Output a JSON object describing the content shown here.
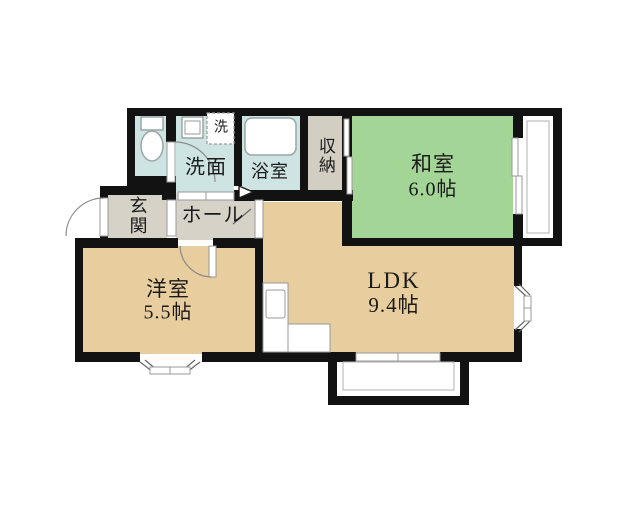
{
  "page": {
    "type": "floor-plan"
  },
  "colors": {
    "bg": "#ffffff",
    "wall": "#121212",
    "washitsu": "#a3d696",
    "ldk": "#e8cd9e",
    "hall": "#d6d2c8",
    "wet": "#cde4e2",
    "storage": "#d2cec2",
    "text": "#1a1a1a"
  },
  "rooms": {
    "washitsu": {
      "name": "和室",
      "size": "6.0帖"
    },
    "ldk": {
      "name": "LDK",
      "size": "9.4帖"
    },
    "youshitsu": {
      "name": "洋室",
      "size": "5.5帖"
    },
    "genkan": {
      "name": "玄関"
    },
    "hall": {
      "name": "ホール"
    },
    "senmen": {
      "name": "洗面"
    },
    "yokushitsu": {
      "name": "浴室"
    },
    "shuunou": {
      "name": "収納"
    },
    "laundry": {
      "name": "洗"
    }
  }
}
